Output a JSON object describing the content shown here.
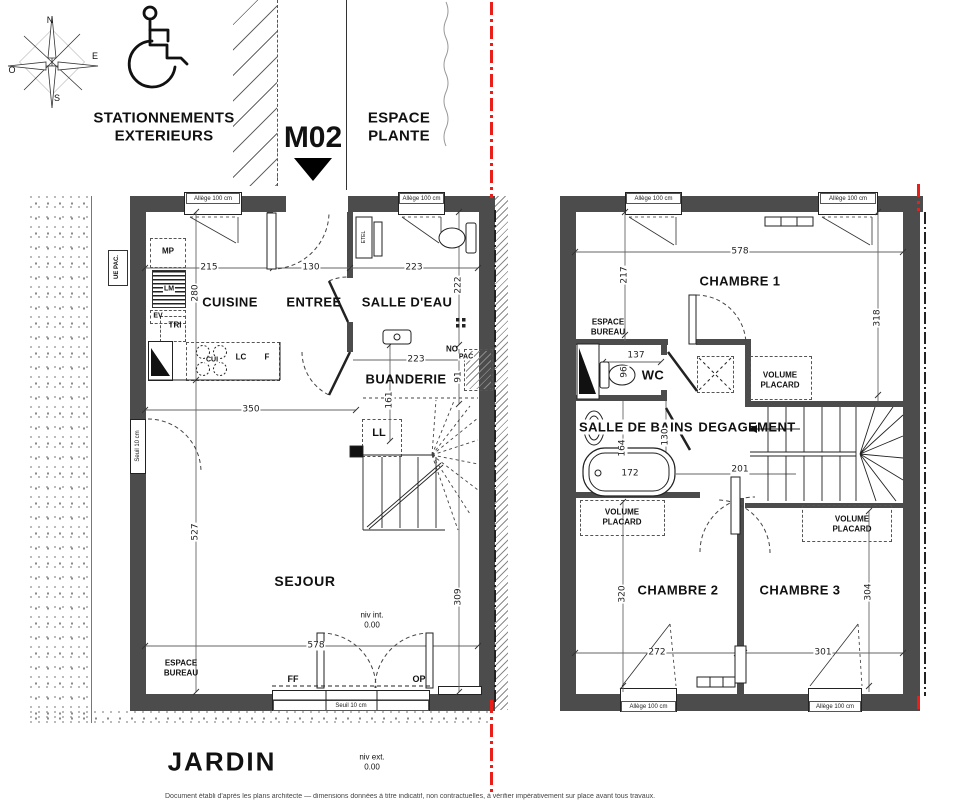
{
  "sheet": {
    "compass": {
      "n": "N",
      "e": "E",
      "s": "S",
      "o": "O"
    },
    "stationnements": {
      "line1": "STATIONNEMENTS",
      "line2": "EXTERIEURS"
    },
    "unit_label": "M02",
    "espace_plante": {
      "line1": "ESPACE",
      "line2": "PLANTE"
    },
    "jardin": "JARDIN",
    "niv_ext": {
      "label": "niv ext.",
      "value": "0.00"
    },
    "fine_print": "Document établi d'après les plans architecte — dimensions données à titre indicatif, non contractuelles, à vérifier impérativement sur place avant tous travaux."
  },
  "common": {
    "allege": "Allège 100 cm",
    "seuil": "Seuil 10 cm",
    "espace_bureau": {
      "line1": "ESPACE",
      "line2": "BUREAU"
    },
    "volume_placard": {
      "line1": "VOLUME",
      "line2": "PLACARD"
    }
  },
  "ground_floor": {
    "rooms": {
      "cuisine": "CUISINE",
      "entree": "ENTREE",
      "salle_eau": "SALLE D'EAU",
      "buanderie": "BUANDERIE",
      "sejour": "SEJOUR"
    },
    "equipment": {
      "mp": "MP",
      "lm": "LM",
      "ev": "EV",
      "tri": "TRI",
      "cui": "CUI",
      "lc": "LC",
      "f": "F",
      "no": "NO",
      "pac": "PAC",
      "ll": "LL",
      "ff": "FF",
      "op": "OP",
      "ue_pac": "UE PAC.",
      "etel": "ETEL"
    },
    "niv_int": {
      "label": "niv int.",
      "value": "0.00"
    },
    "dims": {
      "cuisine_w": "215",
      "entree_w": "130",
      "salle_eau_w": "223",
      "cuisine_d": "280",
      "salle_eau_d": "222",
      "sejour_l": "350",
      "stair_w": "161",
      "buanderie_w": "223",
      "pac_d": "91",
      "sejour_d": "527",
      "sejour_w": "578",
      "east_d": "309"
    }
  },
  "first_floor": {
    "rooms": {
      "chambre1": "CHAMBRE 1",
      "wc": "WC",
      "salle_de_bains": "SALLE DE BAINS",
      "degagement": "DEGAGEMENT",
      "chambre2": "CHAMBRE 2",
      "chambre3": "CHAMBRE 3"
    },
    "dims": {
      "chambre1_w": "578",
      "west_d": "217",
      "east_d": "318",
      "wc_w": "137",
      "wc_d": "96",
      "sdb_d": "164",
      "bain_w": "172",
      "degagement_w": "201",
      "degagement_d": "130",
      "chambre2_d": "320",
      "chambre2_w": "272",
      "chambre3_d": "304",
      "chambre3_w": "301"
    }
  }
}
